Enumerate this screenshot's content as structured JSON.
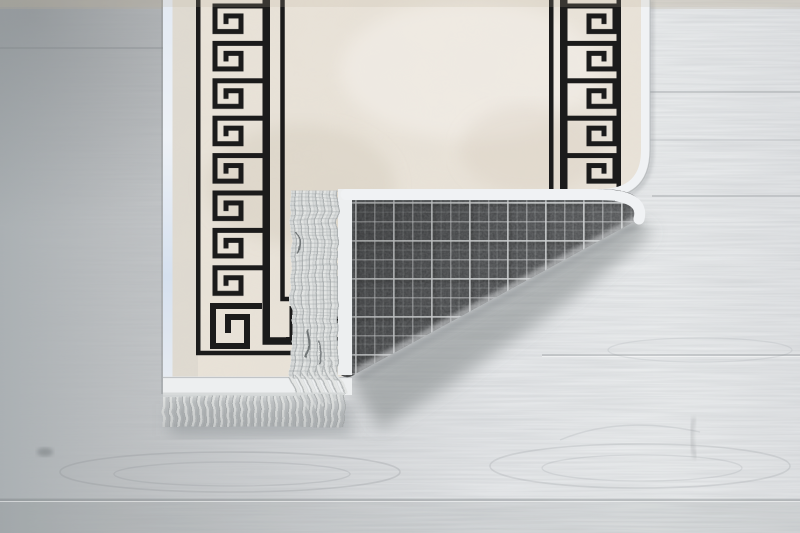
{
  "meta": {
    "alt": "Cream rug with black Greek key meander border, bottom-right corner folded over revealing grey plaid woven backing with silver fringe, on a whitewashed wooden floor"
  },
  "colors": {
    "floor_left": "#aeb1b3",
    "floor_right": "#eceef0",
    "field_cream": "#e8e2d8",
    "field_mottle": "#c9bcab",
    "pattern_black": "#1b1b1b",
    "edge_white": "#f0f2f4",
    "edge_blue": "#dfe7f1",
    "binding_white": "#edeff0",
    "plaid_base": "#47494b",
    "plaid_line": "#d5d8da",
    "fringe_base": "#d6d9d9",
    "fringe_strand": "#e2e4e3",
    "fringe_shade": "#acb0b1",
    "shadow": "#6e7377"
  },
  "rug": {
    "front_motif": "greek-key-meander-border",
    "backing_motif": "grey-tartan-plaid",
    "trim": "silver-fringe"
  }
}
